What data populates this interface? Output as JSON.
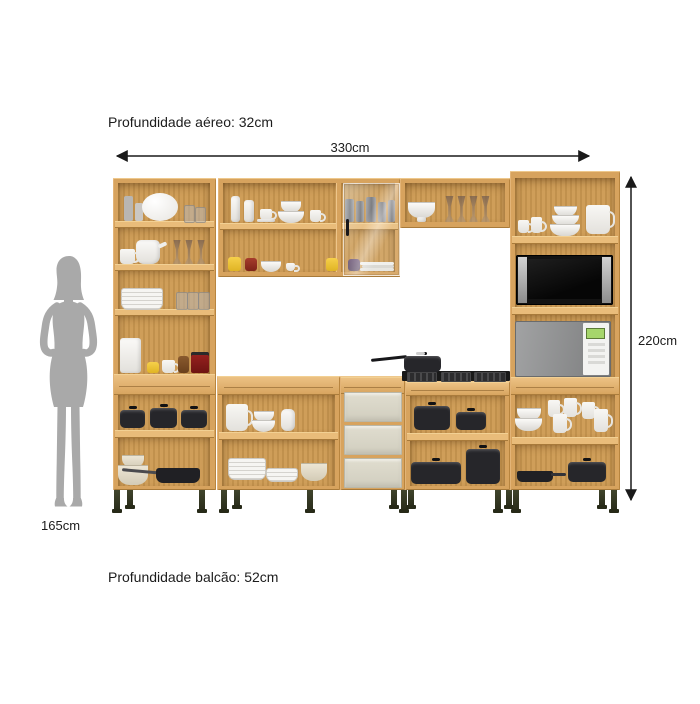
{
  "page": {
    "width": 700,
    "height": 704,
    "background": "#ffffff"
  },
  "annotations": {
    "aerial_depth_label": "Profundidade aéreo: 32cm",
    "width_dimension": "330cm",
    "height_dimension": "220cm",
    "person_height": "165cm",
    "counter_depth_label": "Profundidade balcão: 52cm"
  },
  "colors": {
    "wood_frame": "#d7a35e",
    "wood_interior": "#cd9a52",
    "wood_shelf": "#e9bc7a",
    "drawer_front": "#dad7c8",
    "cabinet_leg": "#3a3e28",
    "silhouette_gray": "#a9a9a9",
    "dimension_line": "#1a1a1a",
    "microwave_black": "#131313",
    "microwave_silver": "#8f9091",
    "cooktop_black": "#191919"
  },
  "scene": {
    "items": [
      "pantry-cabinet",
      "wall-cabinet",
      "glass-door",
      "overhead-cabinet",
      "tower-cabinet",
      "base-cabinet",
      "drawer-unit",
      "cooktop",
      "saucepan",
      "black-microwave",
      "silver-microwave",
      "dishes",
      "pots",
      "woman-silhouette"
    ]
  }
}
